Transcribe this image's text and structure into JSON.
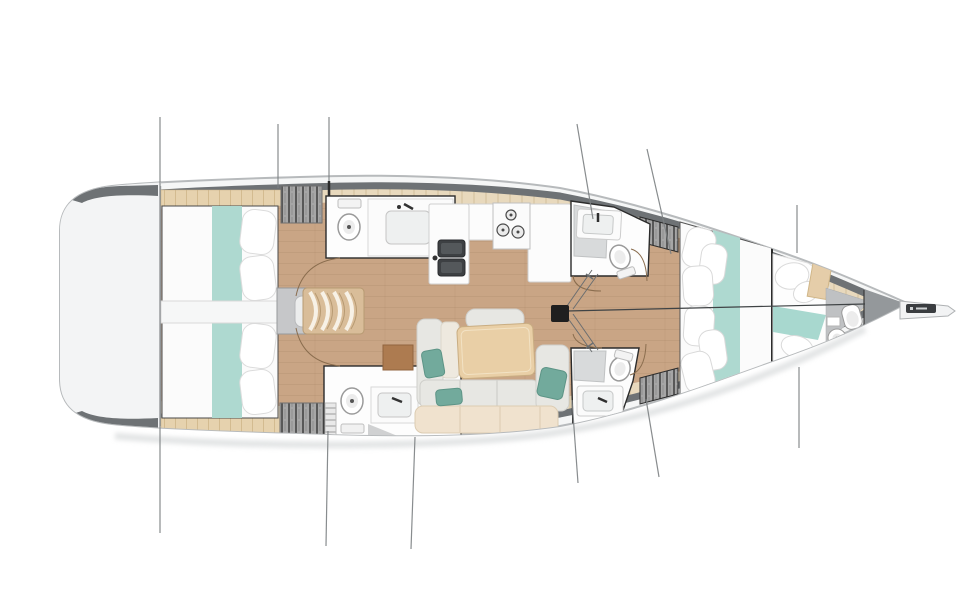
{
  "scene": {
    "title": "Sailboat interior accommodation plan, top-down view, bow pointing right",
    "type": "yacht layout diagram",
    "orientation": {
      "bow": "right",
      "stern": "left",
      "top": "port side",
      "bottom": "starboard side"
    }
  },
  "colors": {
    "hull_rim": "#f5f6f6",
    "hull_outline": "#b7babc",
    "gunwale": "#6e7275",
    "side_deck": "#e8d9bd",
    "deck_tick": "#d2bf9a",
    "cabin_sole_wood": "#c9a585",
    "room_white": "#fdfdfd",
    "room_outline": "#2b2b2b",
    "bed_linen": "#ffffff",
    "teal_runner": "#aed9d0",
    "teal_pillow": "#72aa9c",
    "headboard_wood": "#e6d2ae",
    "table_wood": "#e9cfa6",
    "cushion_gray": "#e7e7e3",
    "bench_cream": "#f0e2ce",
    "wardrobe_gray": "#a6a6a6",
    "steps_wood": "#d9bd99",
    "mast_black": "#1f1f1f",
    "rigging_line": "#7c8082",
    "door_arc": "#8a6d4e"
  },
  "areas": [
    {
      "id": "swim-platform",
      "label": "Transom / swim platform"
    },
    {
      "id": "aft-cabin-port",
      "label": "Aft double cabin (port)",
      "features": [
        "double berth",
        "teal runner",
        "pillows",
        "headboard",
        "wardrobe"
      ]
    },
    {
      "id": "aft-cabin-starboard",
      "label": "Aft double cabin (starboard)",
      "features": [
        "double berth",
        "teal runner",
        "pillows",
        "headboard",
        "wardrobe"
      ]
    },
    {
      "id": "companionway",
      "label": "Companionway steps and engine box"
    },
    {
      "id": "aft-head-port",
      "label": "Aft head (port): toilet and washbasin"
    },
    {
      "id": "aft-head-starboard",
      "label": "Aft head (starboard): toilet, washbasin, locker ladder"
    },
    {
      "id": "galley",
      "label": "Galley: L-counter, double sink, 3-burner stove"
    },
    {
      "id": "head-amidships-port",
      "label": "Amidships head (port): shower, washbasin, toilet"
    },
    {
      "id": "head-amidships-starboard",
      "label": "Amidships head (starboard): shower, washbasin, toilet"
    },
    {
      "id": "salon",
      "label": "Salon: L-settee, armchair, dining table, teal cushions"
    },
    {
      "id": "forward-cabin",
      "label": "Forward owner cabin: island double berth with teal runner"
    },
    {
      "id": "bow-cabin",
      "label": "Bow cabin: berth, washbasin and toilet"
    },
    {
      "id": "mast",
      "label": "Mast foot with shrouds and rigging lines"
    },
    {
      "id": "bowsprit",
      "label": "Bowsprit with anchor roller"
    }
  ],
  "fixtures": {
    "cabins": 4,
    "berths": 4,
    "heads": 5,
    "toilets": 5,
    "washbasins": 5,
    "showers": 2,
    "galley_sink_bowls": 2,
    "stove_burners": 3
  }
}
